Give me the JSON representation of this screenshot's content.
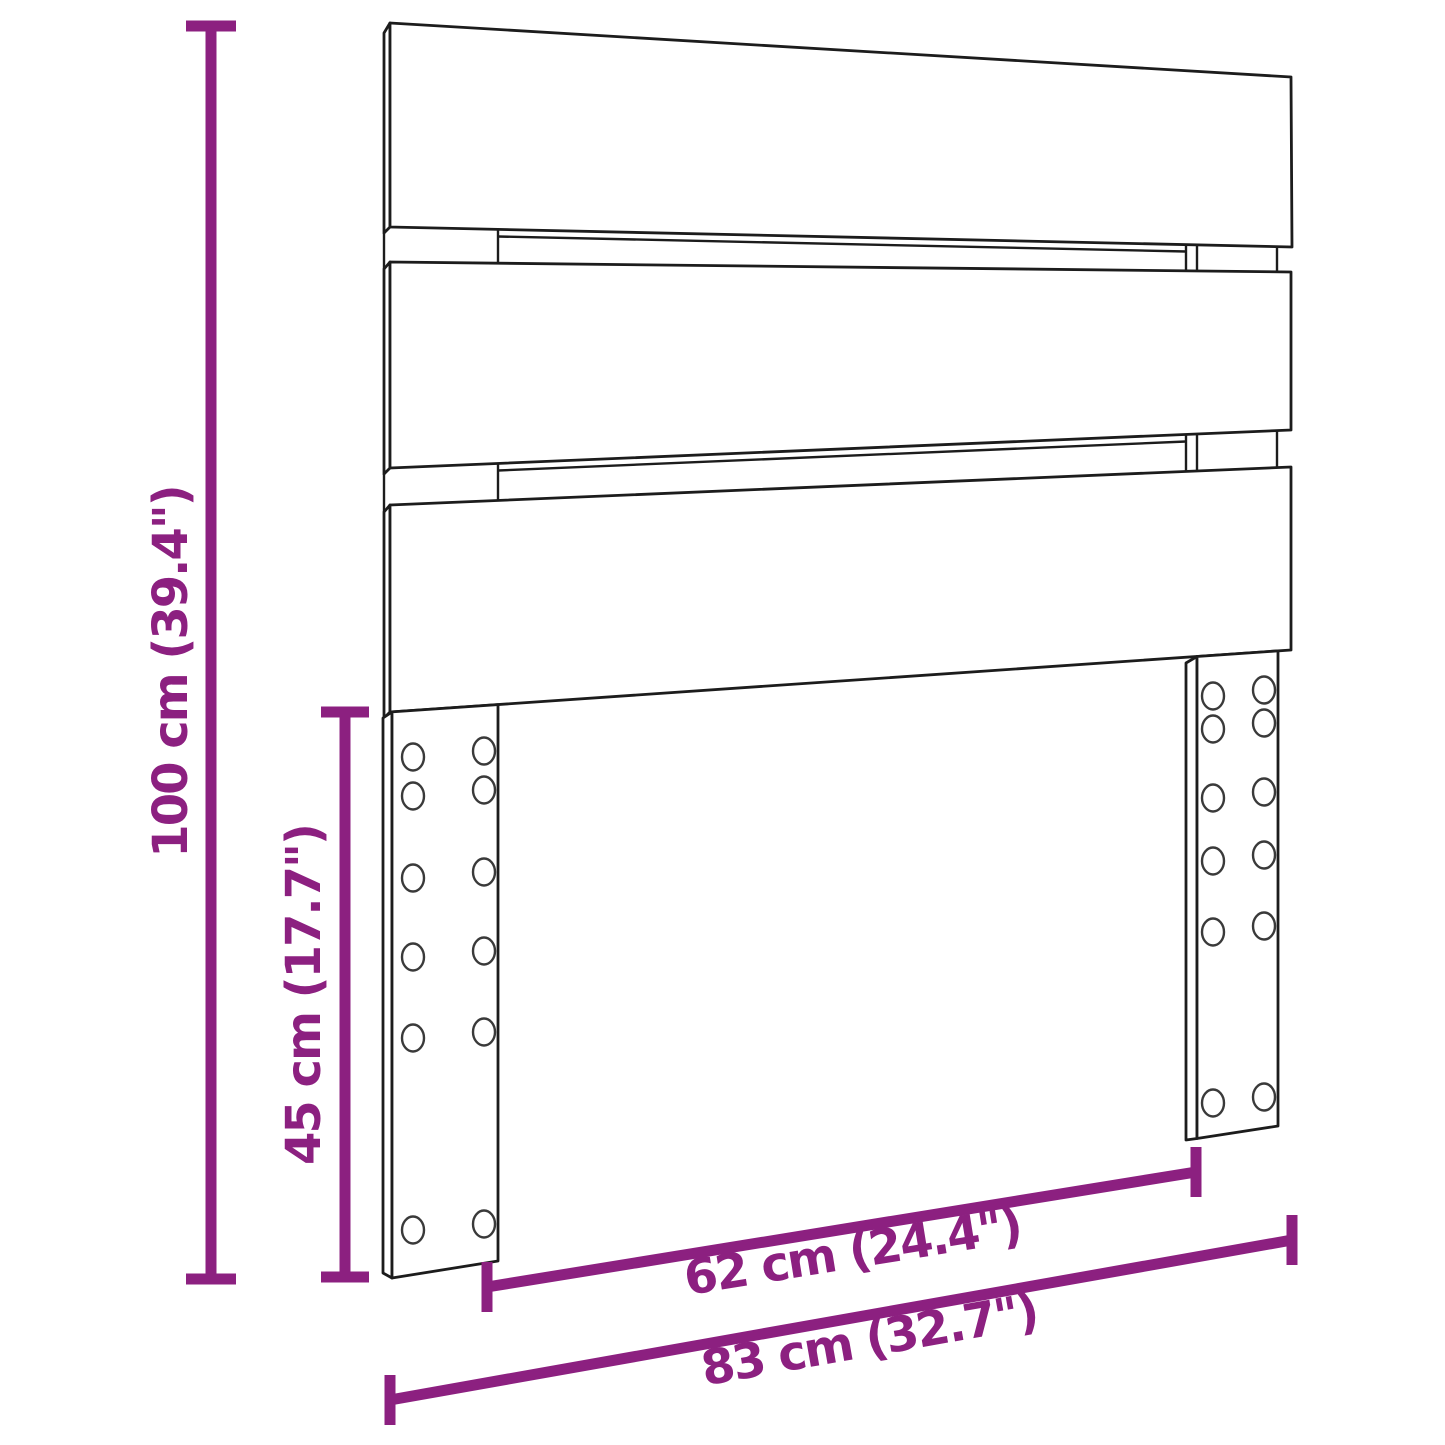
{
  "diagram": {
    "kind": "product-dimension-drawing",
    "subject": "headboard with three slats and two screw-hole legs",
    "background_color": "#ffffff",
    "line_color": "#1c1c1c",
    "accent_color": "#8C2080",
    "structure": {
      "slat_count": 3,
      "leg_count": 2,
      "holes_per_leg": 12,
      "hole_columns_per_leg": 2,
      "hole_rows_per_leg": 6
    },
    "dimensions": [
      {
        "id": "overall-height",
        "label": "100 cm (39.4\")",
        "value_cm": 100,
        "value_in": 39.4,
        "orientation": "vertical"
      },
      {
        "id": "leg-height",
        "label": "45 cm (17.7\")",
        "value_cm": 45,
        "value_in": 17.7,
        "orientation": "vertical"
      },
      {
        "id": "inner-width",
        "label": "62 cm (24.4\")",
        "value_cm": 62,
        "value_in": 24.4,
        "orientation": "diagonal"
      },
      {
        "id": "overall-width",
        "label": "83 cm (32.7\")",
        "value_cm": 83,
        "value_in": 32.7,
        "orientation": "diagonal"
      }
    ]
  }
}
